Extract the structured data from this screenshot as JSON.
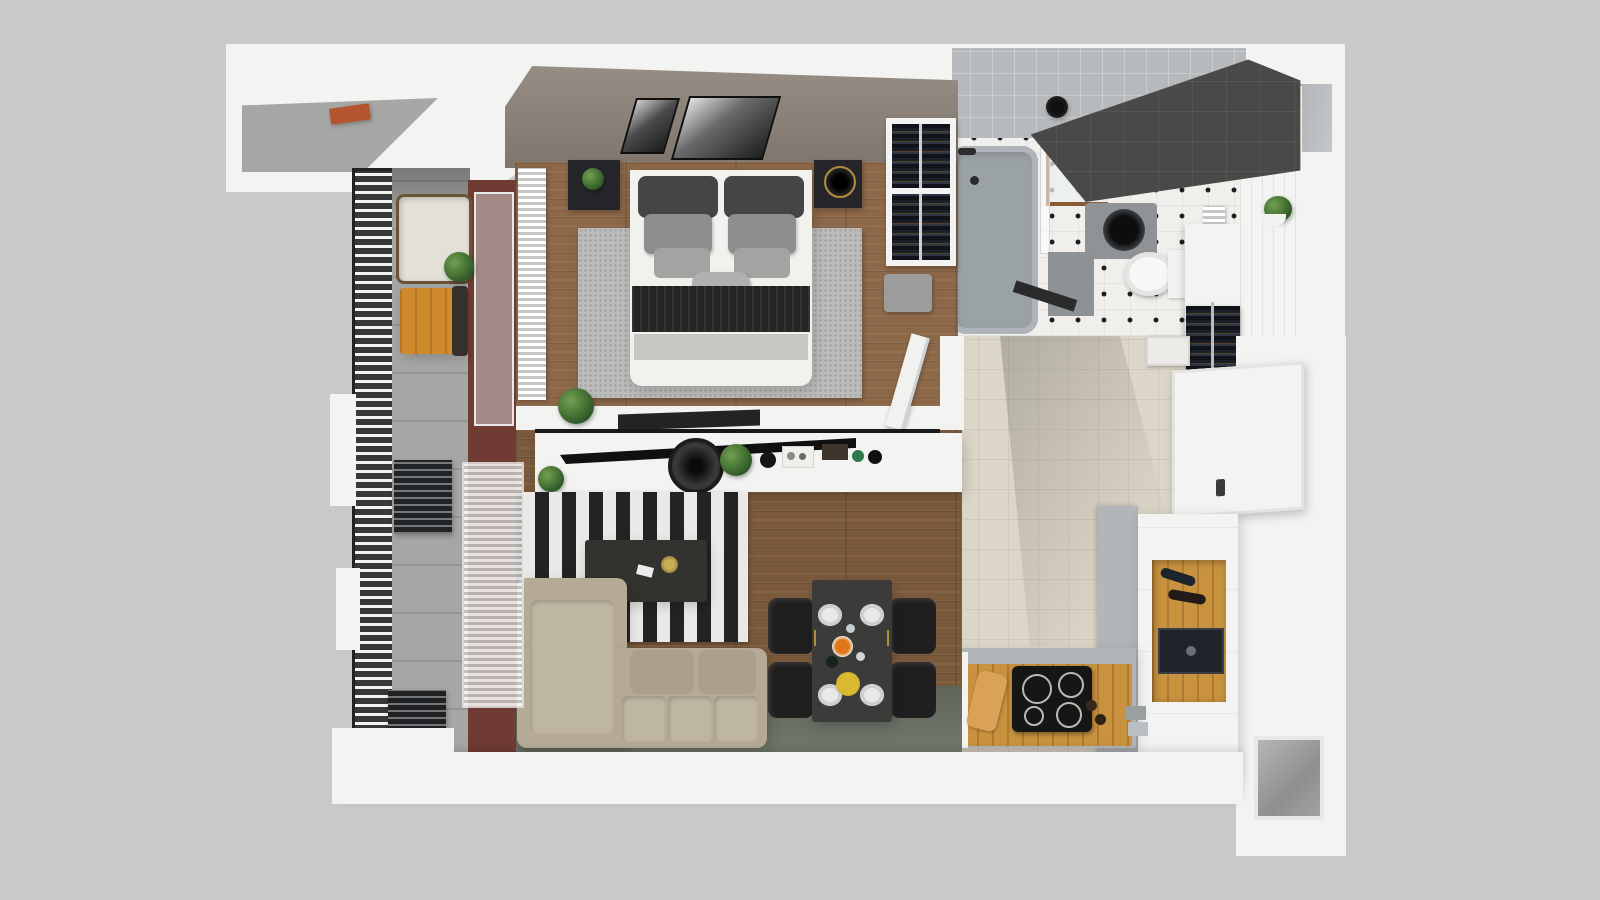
{
  "meta": {
    "scene": "apartment-3d-floor-plan-render",
    "view": "top-down"
  },
  "palette": {
    "bg": "#c9c9c9",
    "wall": "#f3f3f1",
    "roofShade": "#a7a7a5",
    "terracotta": "#b4552e",
    "taupeWall": "#8d837a",
    "maroon": "#6f3b33",
    "woodBedroom": "#8d6848",
    "woodLiving": "#7a5a3b",
    "floorGreen": "#6b7265",
    "rugGray": "#bcbcba",
    "balconyFloor": "#a6a6a4",
    "railingDark": "#2e2e2e",
    "tileBeige": "#dcd6c8",
    "bathFloor": "#f0efec",
    "bathCeiling": "#b7babc",
    "charcoal": "#4b4947",
    "tub": "#9ba2a5",
    "oak": "#c8923f",
    "counter": "#b2b6b9",
    "cooktop": "#161614",
    "sofa": "#b4aa96",
    "sofaLight": "#bfb6a2",
    "tableDark": "#3b3b39",
    "chair": "#1f1f1f",
    "white": "#f6f6f4",
    "black": "#161616"
  },
  "rooms": {
    "balcony": {
      "name": "Balcony",
      "furniture": [
        "slatted-railing",
        "lounge-chair",
        "side-chair",
        "wooden-table",
        "potted-plant",
        "louver-screen",
        "louver-bench"
      ]
    },
    "bedroom": {
      "name": "Bedroom",
      "furniture": [
        "double-bed",
        "headboard-cushions",
        "pillows",
        "black-throw",
        "gray-blanket",
        "area-rug",
        "nightstand-left",
        "nightstand-right",
        "table-lamp",
        "ceiling-mirror-panels",
        "radiator",
        "open-wardrobe",
        "ottoman",
        "desk-shelf",
        "potted-plant"
      ]
    },
    "bathroom": {
      "name": "Bathroom",
      "furniture": [
        "bathtub",
        "shower-head",
        "glass-screen",
        "shower-shelf",
        "washing-machine",
        "toilet",
        "bath-mat",
        "towel-radiator",
        "wall-plant",
        "charcoal-feature-wall"
      ]
    },
    "hallway": {
      "name": "Entry Hall",
      "furniture": [
        "coat-rack",
        "book-stack",
        "entrance-door"
      ]
    },
    "kitchen": {
      "name": "Kitchen",
      "furniture": [
        "island",
        "induction-cooktop",
        "cutting-board",
        "pepper-mills",
        "towels",
        "countertop",
        "tall-cabinet",
        "wine-shelf",
        "built-in-oven"
      ]
    },
    "living_room": {
      "name": "Living Room",
      "furniture": [
        "tv-sideboard",
        "tv",
        "table-fan",
        "decor-trays",
        "striped-rug",
        "coffee-table",
        "corner-sofa",
        "arc-floor-lamp",
        "potted-plants",
        "open-glass-door"
      ]
    },
    "dining_area": {
      "name": "Dining Area",
      "furniture": [
        "dining-table",
        "chair",
        "chair",
        "chair",
        "chair",
        "plates",
        "orange-dish",
        "yellow-plate",
        "wine-bottle",
        "glasses"
      ]
    },
    "building": {
      "name": "Shell",
      "features": [
        "roof-slab",
        "terracotta-vent",
        "top-right-niche",
        "bottom-right-niche",
        "outer-walls"
      ]
    }
  }
}
